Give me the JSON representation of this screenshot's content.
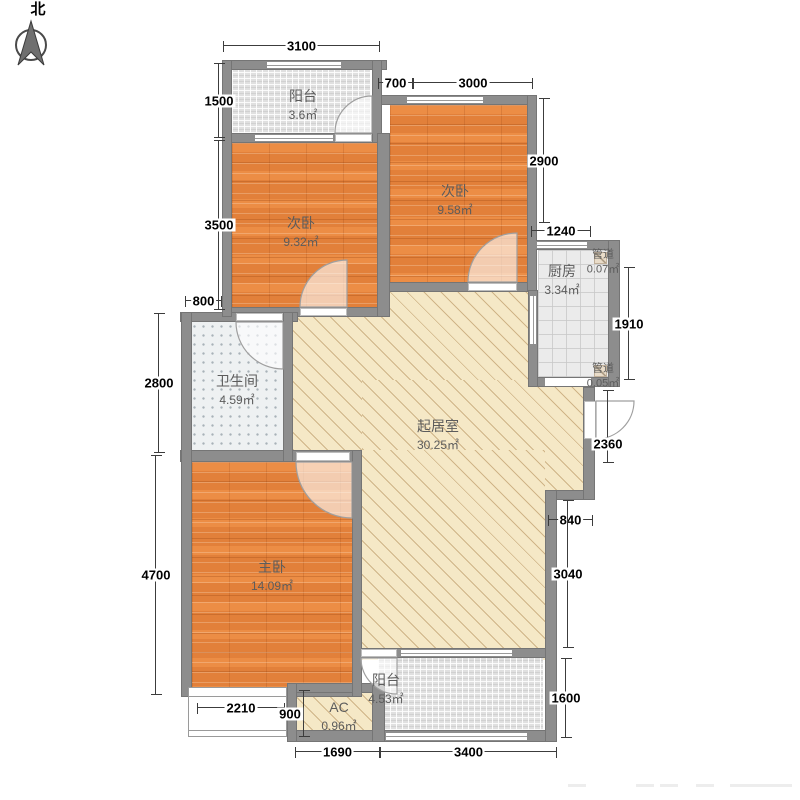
{
  "compass": {
    "north_label": "北"
  },
  "rooms": {
    "balcony_top": {
      "name": "阳台",
      "area": "3.6㎡"
    },
    "bedroom_left": {
      "name": "次卧",
      "area": "9.32㎡"
    },
    "bedroom_right": {
      "name": "次卧",
      "area": "9.58㎡"
    },
    "kitchen": {
      "name": "厨房",
      "area": "3.34㎡"
    },
    "duct_top": {
      "name": "管道",
      "area": "0.07㎡"
    },
    "duct_bottom": {
      "name": "管道",
      "area": "0.05㎡"
    },
    "bathroom": {
      "name": "卫生间",
      "area": "4.59㎡"
    },
    "living": {
      "name": "起居室",
      "area": "30.25㎡"
    },
    "master": {
      "name": "主卧",
      "area": "14.09㎡"
    },
    "balcony_bottom": {
      "name": "阳台",
      "area": "4.53㎡"
    },
    "ac": {
      "name": "AC",
      "area": "0.96㎡"
    }
  },
  "dims": {
    "balcony_top_width": "3100",
    "top_offset": "700",
    "bedroom_right_width": "3000",
    "balcony_top_height": "1500",
    "bedroom_left_height": "3500",
    "bath_offset": "800",
    "bathroom_height": "2800",
    "master_height": "4700",
    "bedroom_right_height": "2900",
    "kitchen_width": "1240",
    "kitchen_height": "1910",
    "entry_wall": "2360",
    "step_width": "840",
    "living_east": "3040",
    "balcony_bottom_height": "1600",
    "bay_window_width": "2210",
    "bay_window_depth": "900",
    "ac_span": "1690",
    "balcony_bottom_width": "3400"
  },
  "colors": {
    "wall": "#8d8d8d",
    "wood_floor": "#e2803a",
    "living_floor": "#f5e8c6",
    "balcony_tile": "#e0e0e0",
    "kitchen_tile": "#ebebeb",
    "bath_floor": "#eef1f2"
  }
}
